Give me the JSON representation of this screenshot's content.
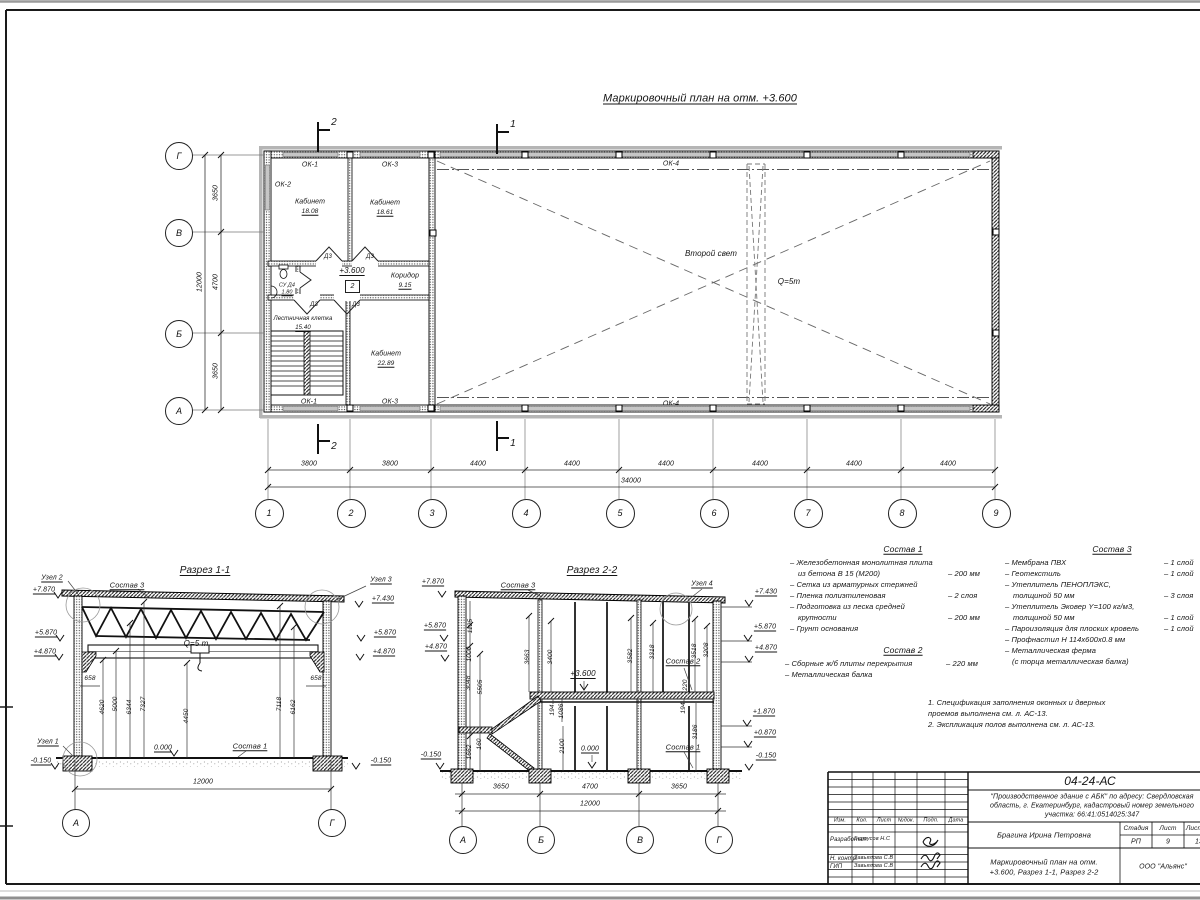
{
  "sheet": {
    "title": "Маркировочный план на отм. +3.600"
  },
  "plan": {
    "axes_cols": [
      "1",
      "2",
      "3",
      "4",
      "5",
      "6",
      "7",
      "8",
      "9"
    ],
    "axes_rows": [
      "Г",
      "В",
      "Б",
      "А"
    ],
    "dims_left": [
      "3650",
      "4700",
      "3650"
    ],
    "dim_left_total": "12000",
    "dims_bottom": [
      "3800",
      "3800",
      "4400",
      "4400",
      "4400",
      "4400",
      "4400",
      "4400"
    ],
    "dim_bottom_total": "34000",
    "cut2": "2",
    "cut1": "1",
    "windows": {
      "ok1": "ОК-1",
      "ok2": "ОК-2",
      "ok3": "ОК-3",
      "ok4": "ОК-4"
    },
    "door": "Д3",
    "level": "+3.600",
    "level_box": "2",
    "rooms": [
      {
        "name": "Кабинет",
        "area": "18.08"
      },
      {
        "name": "Кабинет",
        "area": "18.61"
      },
      {
        "name": "Коридор",
        "area": "9.15"
      },
      {
        "name": "СУ Д4",
        "area": "1.80"
      },
      {
        "name": "Лестничная клетка",
        "area": "15.40"
      },
      {
        "name": "Кабинет",
        "area": "22.89"
      }
    ],
    "second_light": "Второй свет",
    "crane": "Q=5т"
  },
  "section1": {
    "title": "Разрез 1-1",
    "node2": "Узел 2",
    "node3": "Узел 3",
    "node1": "Узел 1",
    "sostav3": "Состав 3",
    "sostav1": "Состав 1",
    "levels_left": [
      "+7.870",
      "+5.870",
      "+4.870"
    ],
    "level_left_bottom": "-0.150",
    "levels_right": [
      "+7.430",
      "+5.870",
      "+4.870"
    ],
    "level_right_bottom": "-0.150",
    "crane": "Q=5 т",
    "zero": "0.000",
    "dim_658_l": "658",
    "dim_658_r": "658",
    "dims_vert": [
      "4620",
      "5000",
      "6344",
      "7327",
      "4450",
      "7118",
      "6162"
    ],
    "dim_total": "12000",
    "axis_left": "А",
    "axis_right": "Г"
  },
  "section2": {
    "title": "Разрез 2-2",
    "sostav3": "Состав 3",
    "node4": "Узел 4",
    "sostav2": "Состав 2",
    "sostav1": "Состав 1",
    "levels_left": [
      "+7.870",
      "+5.870",
      "+4.870"
    ],
    "level_left_bottom": "-0.150",
    "levels_right": [
      "+7.430",
      "+5.870",
      "+4.870",
      "+1.870",
      "+0.870"
    ],
    "level_right_bottom": "-0.150",
    "level_mid": "+3.600",
    "zero": "0.000",
    "dims_left_col": [
      "1125",
      "1000",
      "3048",
      "5505",
      "1662",
      "160"
    ],
    "dims_mid": [
      "3663",
      "3400",
      "194",
      "1086",
      "2100"
    ],
    "dims_right": [
      "3582",
      "3318",
      "3518",
      "3208",
      "220",
      "194",
      "3186"
    ],
    "dims_bottom": [
      "3650",
      "4700",
      "3650"
    ],
    "dim_total": "12000",
    "axes": [
      "А",
      "Б",
      "В",
      "Г"
    ]
  },
  "compositions": {
    "s1_title": "Состав 1",
    "s1": [
      {
        "t": "– Железобетонная  монолитная плита",
        "v": ""
      },
      {
        "t": "из бетона В 15 (М200)",
        "v": "– 200 мм"
      },
      {
        "t": "– Сетка из арматурных стержней",
        "v": ""
      },
      {
        "t": "– Пленка полиэтиленовая",
        "v": "–  2 слоя"
      },
      {
        "t": "– Подготовка из песка средней",
        "v": ""
      },
      {
        "t": "крупности",
        "v": "– 200 мм"
      },
      {
        "t": "– Грунт основания",
        "v": ""
      }
    ],
    "s2_title": "Состав 2",
    "s2": [
      {
        "t": "– Сборные ж/б плиты перекрытия",
        "v": "– 220 мм"
      },
      {
        "t": "– Металлическая балка",
        "v": ""
      }
    ],
    "s3_title": "Состав 3",
    "s3": [
      {
        "t": "– Мембрана ПВХ",
        "v": "– 1 слой"
      },
      {
        "t": "– Геотекстиль",
        "v": "– 1 слой"
      },
      {
        "t": "– Утеплитель ПЕНОПЛЭКС,",
        "v": ""
      },
      {
        "t": "толщиной 50 мм",
        "v": "– 3 слоя"
      },
      {
        "t": "– Утеплитель Эковер Y=100 кг/м3,",
        "v": ""
      },
      {
        "t": "толщиной 50 мм",
        "v": "– 1 слой"
      },
      {
        "t": "– Пароизоляция для плоских кровель",
        "v": "– 1 слой"
      },
      {
        "t": "– Профнастил Н 114х600х0.8 мм",
        "v": ""
      },
      {
        "t": "– Металлическая ферма",
        "v": ""
      },
      {
        "t": "(с торца металлическая балка)",
        "v": ""
      }
    ],
    "notes": [
      "1. Спецификация заполнения оконных и дверных",
      "проемов выполнена см. л. АС-13.",
      "2. Экспликация полов выполнена см. л. АС-13."
    ]
  },
  "titleblock": {
    "code": "04-24-АС",
    "project_line1": "\"Производственное здание с АБК\" по адресу: Свердловская",
    "project_line2": "область, г. Екатеринбург, кадастровый номер земельного",
    "project_line3": "участка: 66:41:0514025:347",
    "col_headers": [
      "Изм.",
      "Кол.",
      "Лист",
      "№док.",
      "Подп.",
      "Дата"
    ],
    "row_developed": "Разработал",
    "dev_name": "Белоусов Н.С",
    "row_ncontr": "Н. контр.",
    "ncontr_name": "Завьялова С.В",
    "row_gip": "ГИП",
    "gip_name": "Завьялова С.В",
    "author": "Брагина Ирина Петровна",
    "stage_h": "Стадия",
    "sheet_h": "Лист",
    "sheets_h": "Листов",
    "stage_v": "РП",
    "sheet_v": "9",
    "sheets_v": "13",
    "doc_line1": "Маркировочный план на отм.",
    "doc_line2": "+3.600, Разрез 1-1, Разрез 2-2",
    "company": "ООО \"Альянс\""
  }
}
